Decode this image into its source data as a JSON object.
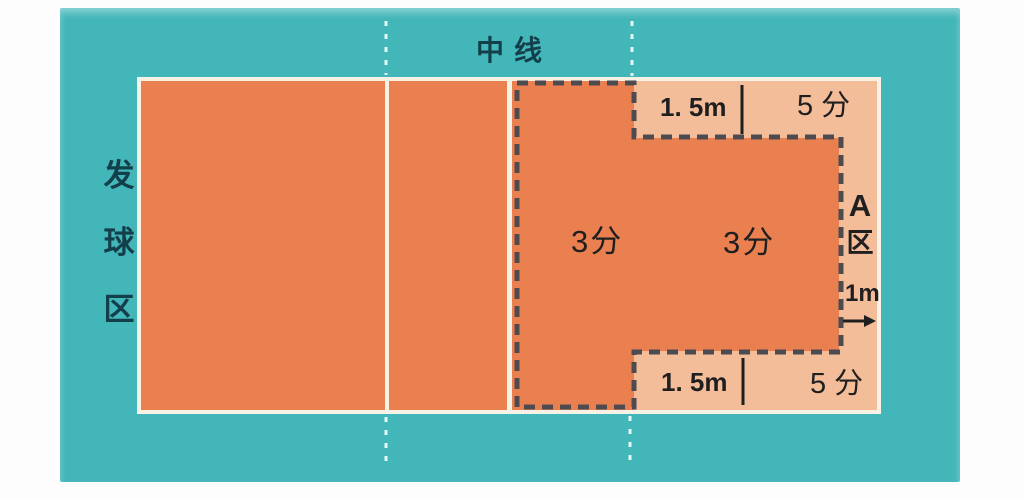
{
  "diagram": {
    "labels": {
      "serving_area_chars": [
        "发",
        "球",
        "区"
      ],
      "center_line": "中线",
      "score_3_left": "3分",
      "score_3_right": "3分",
      "score_5_top": "5 分",
      "score_5_bottom": "5 分",
      "dim_1_5m_top": "1. 5m",
      "dim_1_5m_bottom": "1. 5m",
      "dim_1m": "1m",
      "zone_a_letter": "A",
      "zone_a_char": "区"
    },
    "colors": {
      "floor_teal": "#43b6b9",
      "court_orange": "#ea8050",
      "zone_peach": "#f4bd99",
      "court_line_white": "#f6f2e6",
      "dashed_boundary": "#4e4b50",
      "teal_label_text": "#123f4a",
      "measure_text": "#1f1f1f",
      "page_background": "#fdfdfd"
    }
  }
}
